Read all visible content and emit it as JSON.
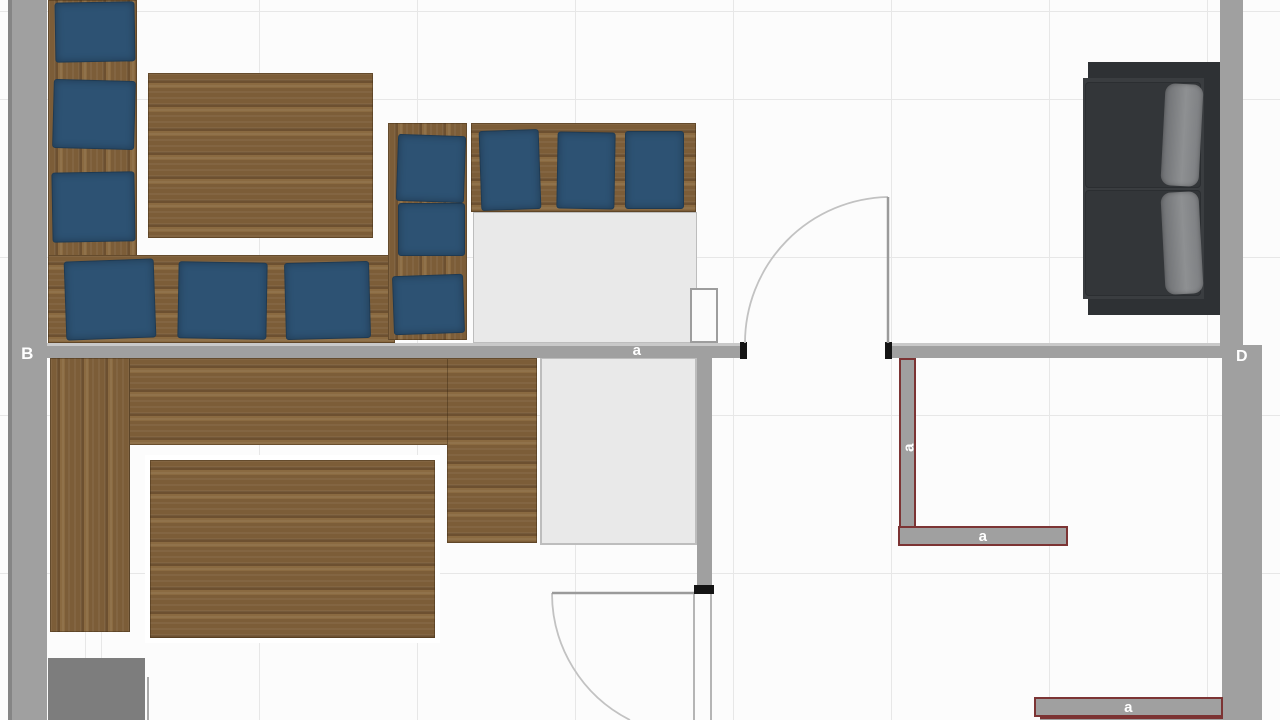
{
  "labels": {
    "left_wall": "B",
    "main_wall": "a",
    "right_wall": "D",
    "partition_vertical": "a",
    "partition_horizontal": "a",
    "bottom_wall": "a"
  },
  "colors": {
    "canvas_bg": "#fcfcfc",
    "grid_line": "#e7e7e7",
    "wall_fill": "#a0a0a0",
    "wall_edge": "#858585",
    "wall_highlight": "#c9c9c9",
    "wall_cap": "#141414",
    "selected_outline": "#7c3434",
    "wood_base": "#7c5d38",
    "wood_dark": "#6d5030",
    "wood_light": "#8a6a41",
    "cushion_blue": "#2d5273",
    "cushion_border": "#1f3a52",
    "counter_fill": "#e9e9e9",
    "counter_border": "#bdbdbd",
    "column_fill": "#fbfbfb",
    "cabinet_fill": "#7d7d7d",
    "sofa_frame": "#2e3134",
    "sofa_body": "#3a3d40",
    "sofa_cushion": "#333639",
    "sofa_back": "#8e9092",
    "door_arc": "#c2c2c2",
    "door_leaf": "#9a9a9a"
  }
}
